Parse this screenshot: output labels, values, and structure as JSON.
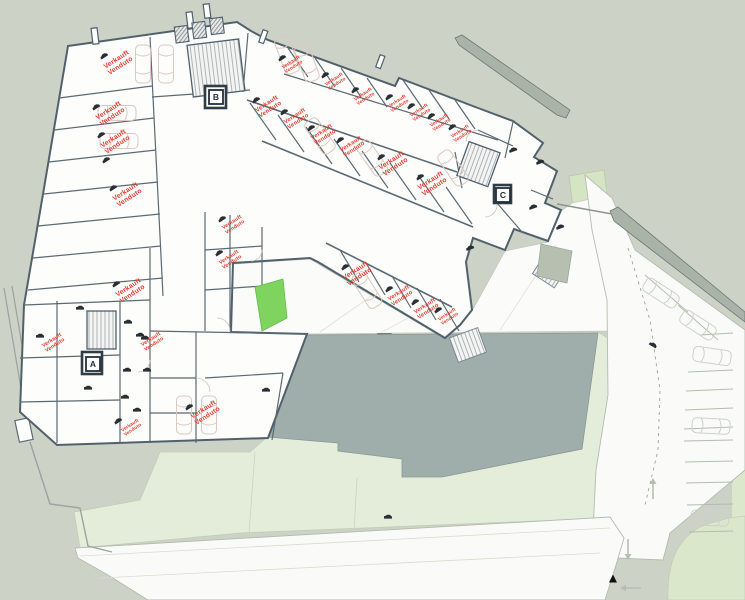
{
  "plan": {
    "sold_label": {
      "line1": "Verkauft",
      "line2": "Venduto"
    },
    "stair_badges": [
      {
        "label": "A",
        "x": 93,
        "y": 364
      },
      {
        "label": "B",
        "x": 216,
        "y": 97
      },
      {
        "label": "C",
        "x": 503,
        "y": 195
      }
    ],
    "colors": {
      "background": "#cdd2c6",
      "building_fill": "#fdfdfb",
      "wall": "#51616c",
      "sold_text": "#e23b2e",
      "lawn": "#e4edda",
      "grass_bright": "#7fd35f",
      "green_light": "#d5e5c3",
      "footprint_grey": "#9fadab",
      "boundary_wall": "#a9b3a7",
      "car_outline": "#dcc8c1",
      "outdoor_car": "#ccd2c8",
      "icon_dark": "#2a2f33",
      "road_line": "#b4bbb0"
    },
    "sold_spots": [
      {
        "x": 118,
        "y": 62,
        "r": -33,
        "s": 1
      },
      {
        "x": 110,
        "y": 113,
        "r": -33,
        "s": 1
      },
      {
        "x": 115,
        "y": 141,
        "r": -33,
        "s": 1
      },
      {
        "x": 127,
        "y": 194,
        "r": -33,
        "s": 1
      },
      {
        "x": 130,
        "y": 290,
        "r": -33,
        "s": 1
      },
      {
        "x": 53,
        "y": 342,
        "r": -33,
        "s": 0.78
      },
      {
        "x": 152,
        "y": 341,
        "r": -33,
        "s": 0.78
      },
      {
        "x": 131,
        "y": 427,
        "r": -33,
        "s": 0.7
      },
      {
        "x": 205,
        "y": 412,
        "r": -33,
        "s": 1
      },
      {
        "x": 233,
        "y": 224,
        "r": -33,
        "s": 0.78
      },
      {
        "x": 230,
        "y": 259,
        "r": -33,
        "s": 0.78
      },
      {
        "x": 292,
        "y": 64,
        "r": -33,
        "s": 0.72
      },
      {
        "x": 335,
        "y": 81,
        "r": -33,
        "s": 0.72
      },
      {
        "x": 364,
        "y": 96,
        "r": -33,
        "s": 0.72
      },
      {
        "x": 398,
        "y": 103,
        "r": -33,
        "s": 0.72
      },
      {
        "x": 420,
        "y": 112,
        "r": -33,
        "s": 0.72
      },
      {
        "x": 440,
        "y": 122,
        "r": -33,
        "s": 0.72
      },
      {
        "x": 461,
        "y": 133,
        "r": -33,
        "s": 0.72
      },
      {
        "x": 268,
        "y": 106,
        "r": -33,
        "s": 0.9
      },
      {
        "x": 296,
        "y": 118,
        "r": -33,
        "s": 0.85
      },
      {
        "x": 323,
        "y": 134,
        "r": -33,
        "s": 0.85
      },
      {
        "x": 352,
        "y": 146,
        "r": -33,
        "s": 0.85
      },
      {
        "x": 393,
        "y": 163,
        "r": -33,
        "s": 1
      },
      {
        "x": 432,
        "y": 183,
        "r": -33,
        "s": 1
      },
      {
        "x": 357,
        "y": 273,
        "r": -33,
        "s": 1
      },
      {
        "x": 400,
        "y": 295,
        "r": -33,
        "s": 0.85
      },
      {
        "x": 426,
        "y": 308,
        "r": -33,
        "s": 0.85
      },
      {
        "x": 448,
        "y": 316,
        "r": -33,
        "s": 0.7
      }
    ],
    "car_icons": [
      {
        "x": 104,
        "y": 56,
        "r": -33
      },
      {
        "x": 96,
        "y": 107,
        "r": -33
      },
      {
        "x": 101,
        "y": 135,
        "r": -33
      },
      {
        "x": 106,
        "y": 160,
        "r": -33
      },
      {
        "x": 113,
        "y": 188,
        "r": -33
      },
      {
        "x": 116,
        "y": 284,
        "r": -33
      },
      {
        "x": 40,
        "y": 336,
        "r": 0
      },
      {
        "x": 140,
        "y": 335,
        "r": 0
      },
      {
        "x": 118,
        "y": 421,
        "r": -33
      },
      {
        "x": 189,
        "y": 407,
        "r": -33
      },
      {
        "x": 222,
        "y": 219,
        "r": -33
      },
      {
        "x": 219,
        "y": 253,
        "r": -33
      },
      {
        "x": 282,
        "y": 58,
        "r": -33
      },
      {
        "x": 325,
        "y": 75,
        "r": -33
      },
      {
        "x": 355,
        "y": 90,
        "r": -33
      },
      {
        "x": 389,
        "y": 97,
        "r": -33
      },
      {
        "x": 411,
        "y": 106,
        "r": -33
      },
      {
        "x": 431,
        "y": 116,
        "r": -33
      },
      {
        "x": 452,
        "y": 127,
        "r": -33
      },
      {
        "x": 256,
        "y": 100,
        "r": -33
      },
      {
        "x": 284,
        "y": 112,
        "r": -33
      },
      {
        "x": 311,
        "y": 128,
        "r": -33
      },
      {
        "x": 340,
        "y": 140,
        "r": -33
      },
      {
        "x": 381,
        "y": 157,
        "r": -33
      },
      {
        "x": 420,
        "y": 177,
        "r": -33
      },
      {
        "x": 345,
        "y": 267,
        "r": -33
      },
      {
        "x": 389,
        "y": 289,
        "r": -33
      },
      {
        "x": 415,
        "y": 302,
        "r": -33
      },
      {
        "x": 438,
        "y": 310,
        "r": -33
      },
      {
        "x": 80,
        "y": 308,
        "r": 0
      },
      {
        "x": 128,
        "y": 322,
        "r": 0
      },
      {
        "x": 145,
        "y": 338,
        "r": 0
      },
      {
        "x": 127,
        "y": 370,
        "r": 0
      },
      {
        "x": 147,
        "y": 370,
        "r": 0
      },
      {
        "x": 88,
        "y": 388,
        "r": 0
      },
      {
        "x": 125,
        "y": 397,
        "r": 0
      },
      {
        "x": 137,
        "y": 410,
        "r": 0
      },
      {
        "x": 266,
        "y": 390,
        "r": 0
      },
      {
        "x": 470,
        "y": 248,
        "r": -20
      },
      {
        "x": 533,
        "y": 207,
        "r": -20
      },
      {
        "x": 560,
        "y": 227,
        "r": -20
      },
      {
        "x": 513,
        "y": 150,
        "r": -20
      },
      {
        "x": 540,
        "y": 162,
        "r": -20
      },
      {
        "x": 653,
        "y": 345,
        "r": 30
      },
      {
        "x": 388,
        "y": 517,
        "r": 0
      }
    ],
    "cars_inside": [
      {
        "x": 143,
        "y": 64,
        "r": 90
      },
      {
        "x": 166,
        "y": 64,
        "r": 90
      },
      {
        "x": 117,
        "y": 113,
        "r": 0
      },
      {
        "x": 119,
        "y": 141,
        "r": 0
      },
      {
        "x": 287,
        "y": 55,
        "r": 70
      },
      {
        "x": 307,
        "y": 63,
        "r": 70
      },
      {
        "x": 320,
        "y": 136,
        "r": 55
      },
      {
        "x": 372,
        "y": 158,
        "r": 55
      },
      {
        "x": 453,
        "y": 168,
        "r": 55
      },
      {
        "x": 367,
        "y": 290,
        "r": 58
      },
      {
        "x": 184,
        "y": 415,
        "r": 90
      },
      {
        "x": 209,
        "y": 415,
        "r": 90
      }
    ],
    "cars_outdoor": [
      {
        "x": 661,
        "y": 293,
        "r": 33
      },
      {
        "x": 698,
        "y": 325,
        "r": 33
      },
      {
        "x": 712,
        "y": 356,
        "r": 8
      },
      {
        "x": 711,
        "y": 426,
        "r": 3
      },
      {
        "x": 710,
        "y": 518,
        "r": 2
      }
    ],
    "arrows": [
      {
        "x": 653,
        "y": 489,
        "dir": "up"
      },
      {
        "x": 628,
        "y": 549,
        "dir": "down"
      },
      {
        "x": 631,
        "y": 588,
        "dir": "left"
      }
    ],
    "marker_triangle": {
      "x": 613,
      "y": 579
    }
  }
}
